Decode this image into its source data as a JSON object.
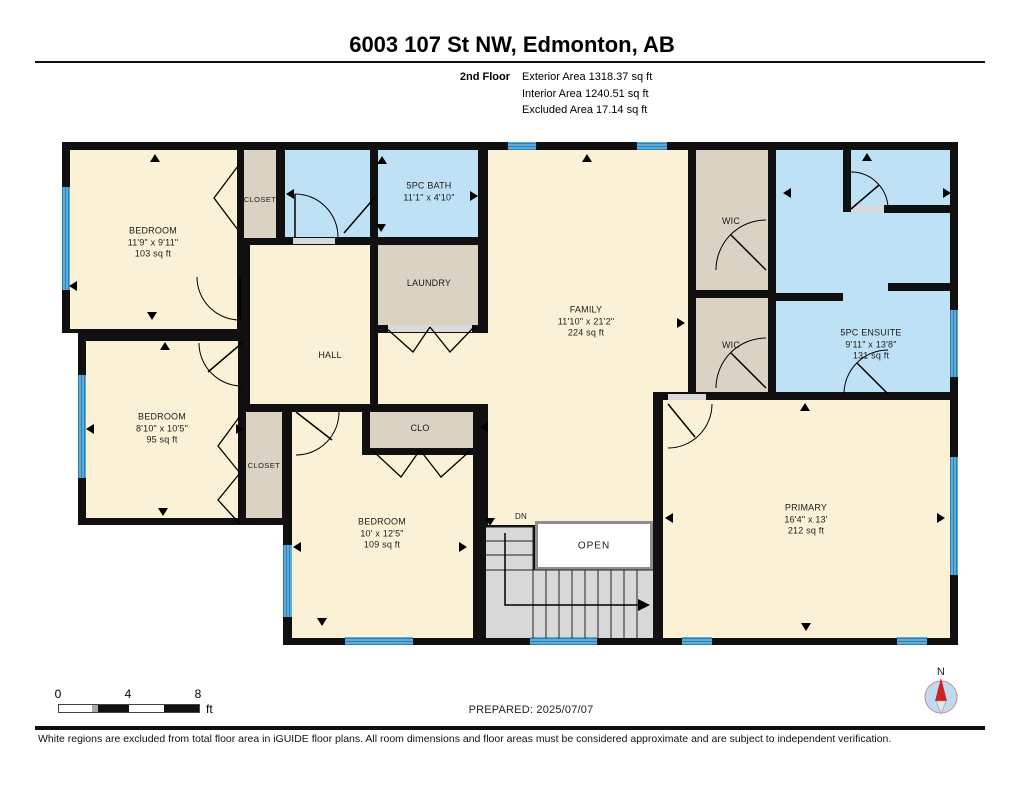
{
  "header": {
    "title": "6003 107 St NW, Edmonton, AB",
    "floor_label": "2nd Floor",
    "area_lines": [
      "Exterior Area 1318.37 sq ft",
      "Interior Area 1240.51 sq ft",
      "Excluded Area 17.14 sq ft"
    ]
  },
  "rooms": {
    "bedroom_top_left": {
      "name": "BEDROOM",
      "dims": "11'9\" x 9'11\"",
      "area": "103 sq ft"
    },
    "closet_top": {
      "name": "CLOSET"
    },
    "bath": {
      "name": "5PC BATH",
      "dims": "11'1\" x 4'10\""
    },
    "laundry": {
      "name": "LAUNDRY"
    },
    "hall": {
      "name": "HALL"
    },
    "family": {
      "name": "FAMILY",
      "dims": "11'10\" x 21'2\"",
      "area": "224 sq ft"
    },
    "wic_upper": {
      "name": "WIC"
    },
    "wic_lower": {
      "name": "WIC"
    },
    "ensuite": {
      "name": "5PC ENSUITE",
      "dims": "9'11\" x 13'8\"",
      "area": "131 sq ft"
    },
    "bedroom_mid_left": {
      "name": "BEDROOM",
      "dims": "8'10\" x 10'5\"",
      "area": "95 sq ft"
    },
    "closet_mid": {
      "name": "CLOSET"
    },
    "closet_bottom": {
      "name": "CLO"
    },
    "bedroom_bottom": {
      "name": "BEDROOM",
      "dims": "10' x 12'5\"",
      "area": "109 sq ft"
    },
    "primary": {
      "name": "PRIMARY",
      "dims": "16'4\" x 13'",
      "area": "212 sq ft"
    },
    "open_area": {
      "label": "OPEN"
    },
    "stairs": {
      "label": "DN"
    }
  },
  "footer": {
    "scale_ticks": [
      "0",
      "4",
      "8"
    ],
    "scale_unit": "ft",
    "prepared": "PREPARED: 2025/07/07",
    "compass_label": "N",
    "disclaimer": "White regions are excluded from total floor area in iGUIDE floor plans. All room dimensions and floor areas must be considered approximate and are subject to independent verification."
  },
  "colors": {
    "room_fill": "#FAF1D6",
    "closet_fill": "#DAD2C3",
    "bath_fill": "#BFE1F5",
    "window_blue": "#58A7D6",
    "wall": "#111111",
    "stairs_gray": "#D8D8D8"
  }
}
